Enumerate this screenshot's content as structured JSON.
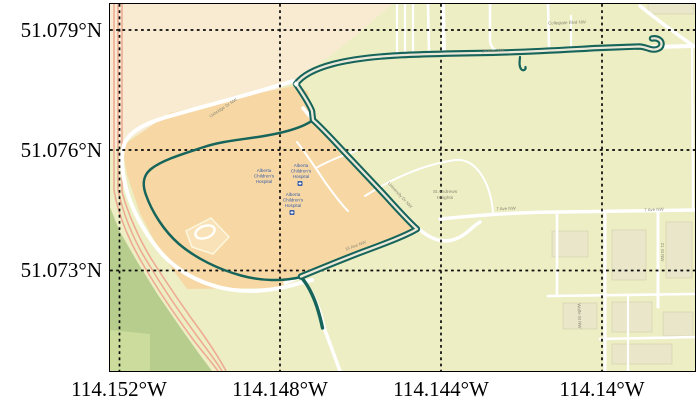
{
  "axes": {
    "x_ticks": [
      "114.152°W",
      "114.148°W",
      "114.144°W",
      "114.14°W"
    ],
    "y_ticks": [
      "51.079°N",
      "51.076°N",
      "51.073°N"
    ]
  },
  "colors": {
    "track": "#16645a",
    "track_gap": "#ece9d9",
    "base": "#edeec3",
    "cream": "#f8ebd1",
    "campus": "#f7d8a5",
    "park_green": "#b7cd8e",
    "park_green_light": "#ccdc9c",
    "rail_pink": "#eeab94",
    "road": "#ffffff",
    "grid": "#0a0a0a",
    "hospital_label": "#3c5fa6",
    "road_label": "#8b8875"
  },
  "map": {
    "hospital_label": {
      "line1": "Alberta",
      "line2": "Children's",
      "line3": "Hospital"
    },
    "neighborhood_label": {
      "line1": "St Andrews",
      "line2": "Heights"
    },
    "road_labels": [
      {
        "text": "Uxbridge Dr NW"
      },
      {
        "text": "24 Ave NW"
      },
      {
        "text": "Collegiate Blvd NW"
      },
      {
        "text": "University Dr NW"
      },
      {
        "text": "16 Ave NW"
      },
      {
        "text": "7 Ave NW"
      },
      {
        "text": "7 Ave NW"
      },
      {
        "text": "21 St NW"
      },
      {
        "text": "Wolfe St NW"
      }
    ]
  },
  "track": {
    "main_path": "M652,38.5 C657,37.5 662,40 661.5,44.5 C661,49 655,50.5 650,49 C646.5,48 643,46.5 639,46.5 L598,48 C560,50 520,52.5 480,53 C450,53.5 420,54 395,55.5 C370,57 348,60 333,64 C316,68.5 303,74.5 296,84 C302,93 309,103 312,111 L313,120 C322,128 334,141 346,154 L380,190 C393,204 406,219 417,229 C405,236 385,243.5 362,252 C341,260 318,269.5 301,276.5",
    "west_loop_path": "M313,120 C303,127.5 285,132.5 264,136 C243,139.5 222,141 204,147 C184,153.5 162,160 151,169 C143,175.5 142,184 146,195 C152,212 164,231 179,244 C196,258.5 219,269.5 241,275.5 C261,281 283,281.5 301,277",
    "spur_path": "M301,277 C308,285 313,295 317,307 C319.5,315 321.5,323 322.5,328",
    "hook_path": "M520,57 C519.5,62 519,66 521,69 C523,71.5 526,70 525.5,67"
  }
}
